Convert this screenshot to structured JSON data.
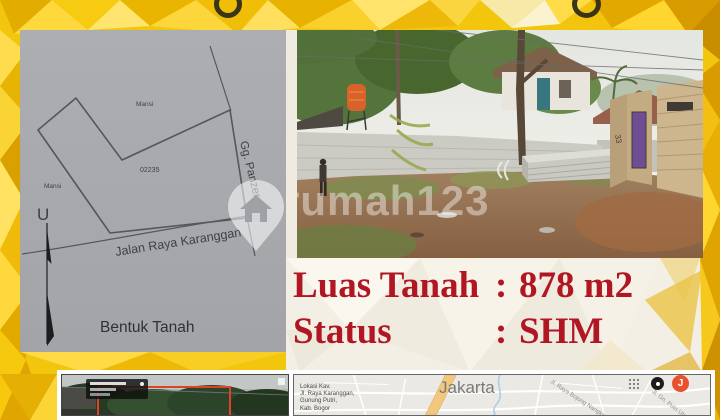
{
  "colors": {
    "accent_red": "#B11623",
    "brand_yellow": "#F3C60E",
    "sketch_paper": "#A8AAAE",
    "annotation_red_box": "#DD4327",
    "map_avatar_orange": "#E8512C"
  },
  "sketch": {
    "caption": "Bentuk Tanah",
    "north_label": "U",
    "parcel_number": "02235",
    "neighbor_top": "Mansi",
    "neighbor_left": "Mansi",
    "alley_label": "Gg. Panzer",
    "road_label": "Jalan Raya Karanggan"
  },
  "photo": {
    "watermark": "rumah123"
  },
  "details": {
    "rows": [
      {
        "label": "Luas Tanah",
        "sep": ":",
        "value": "878 m2"
      },
      {
        "label": "Status",
        "sep": ":",
        "value": "SHM"
      }
    ]
  },
  "map": {
    "city": "Jakarta",
    "address": [
      "Lokasi Kav.",
      "Jl. Raya Karanggan,",
      "Gunung Putri,",
      "Kab. Bogor"
    ],
    "roads": [
      "Jl. Raya Bojong Nangka",
      "Jl. Gn. Putri Utara"
    ],
    "avatar": "J"
  }
}
